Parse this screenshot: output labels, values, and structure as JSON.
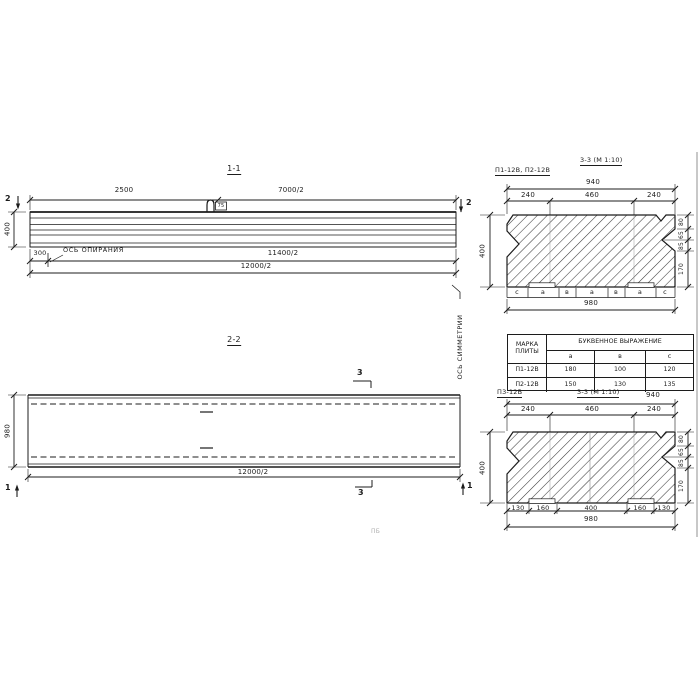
{
  "s11": {
    "title": "1-1",
    "cut_label": "2",
    "dim_top_left": "2500",
    "dim_top_right": "7000/2",
    "dim_height": "400",
    "dim_support": "300",
    "support_axis_label": "ОСЬ ОПИРАНИЯ",
    "dim_len1": "11400/2",
    "dim_len2": "12000/2",
    "loop_tag": "75"
  },
  "s22": {
    "title": "2-2",
    "cut_label_3": "3",
    "cut_label_1": "1",
    "dim_height": "980",
    "dim_length": "12000/2",
    "symmetry_axis_label": "ОСЬ СИММЕТРИИ"
  },
  "s33a": {
    "marks_label": "П1-12В, П2-12В",
    "title": "3-3 (М 1:10)",
    "dim_940": "940",
    "top_dims": [
      "240",
      "460",
      "240"
    ],
    "dim_height": "400",
    "right_dims": [
      "80",
      "65",
      "85",
      "170"
    ],
    "letters": [
      "с",
      "а",
      "в",
      "а",
      "в",
      "а",
      "с"
    ],
    "dim_980": "980"
  },
  "table": {
    "header_mark_line1": "МАРКА",
    "header_mark_line2": "ПЛИТЫ",
    "header_expr": "БУКВЕННОЕ  ВЫРАЖЕНИЕ",
    "cols": [
      "а",
      "в",
      "с"
    ],
    "rows": [
      {
        "mark": "П1-12В",
        "a": "180",
        "b": "100",
        "c": "120"
      },
      {
        "mark": "П2-12В",
        "a": "150",
        "b": "130",
        "c": "135"
      }
    ]
  },
  "s33b": {
    "mark_label": "П3-12В",
    "title": "3-3 (М 1:10)",
    "dim_940": "940",
    "top_dims": [
      "240",
      "460",
      "240"
    ],
    "dim_height": "400",
    "right_dims": [
      "80",
      "65",
      "85",
      "170"
    ],
    "bottom_dims": [
      "130",
      "160",
      "400",
      "160",
      "130"
    ],
    "dim_980": "980"
  },
  "note_faint": "ПБ"
}
